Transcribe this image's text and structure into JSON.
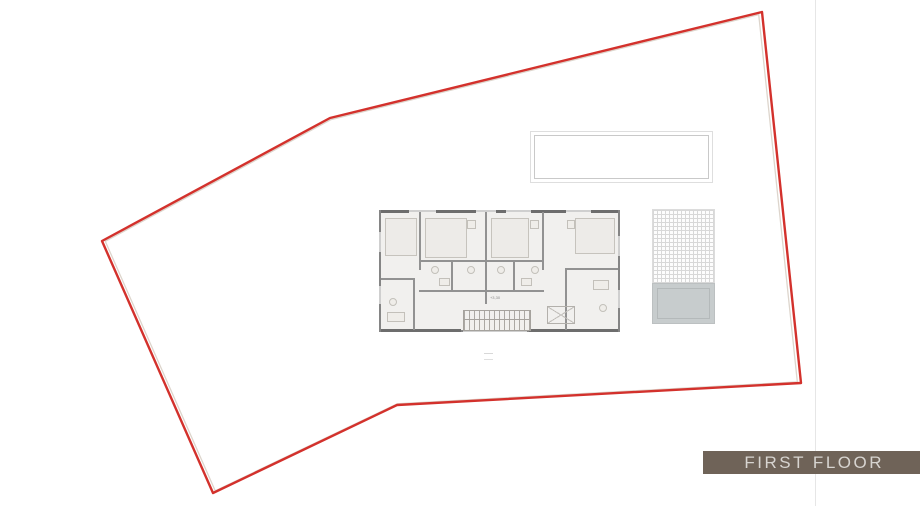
{
  "banner": {
    "label": "FIRST FLOOR",
    "background": "#6f6358",
    "text_color": "#d7d4d0"
  },
  "site": {
    "boundary_color": "#d3312c",
    "offset_line_color": "#ddd5cc",
    "boundary_points": [
      [
        762,
        12
      ],
      [
        330,
        118
      ],
      [
        102,
        241
      ],
      [
        213,
        493
      ],
      [
        397,
        405
      ],
      [
        801,
        383
      ]
    ]
  },
  "floorplan": {
    "elevation_label": "+3,30",
    "wall_color": "#858585",
    "fill_color": "#f1f0ee"
  }
}
